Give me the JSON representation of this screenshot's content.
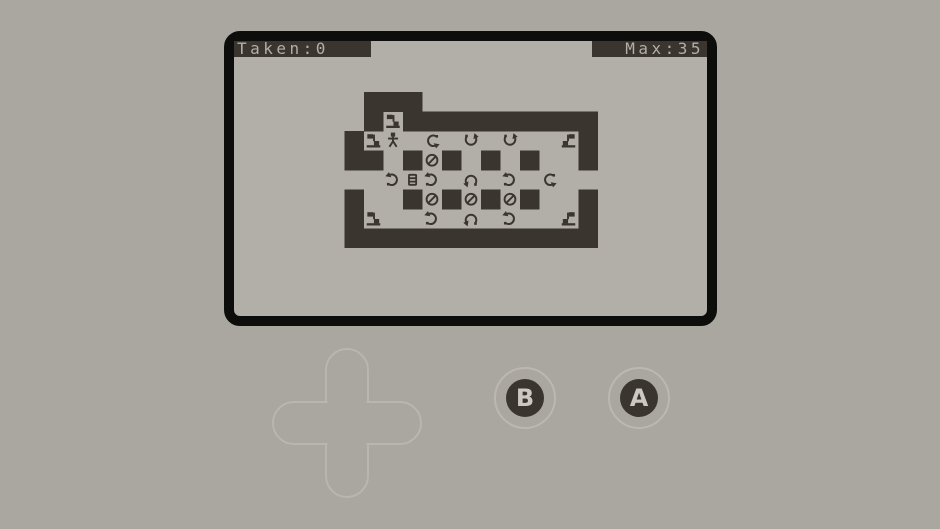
{
  "hud": {
    "taken_label": "Taken:0",
    "max_label": "Max:35",
    "taken_value": 0,
    "max_value": 35
  },
  "controls": {
    "button_b_label": "B",
    "button_a_label": "A"
  },
  "map": {
    "tile_size": 19.5,
    "cols": 13,
    "rows": 8,
    "grid": [
      " ###         ",
      " #F##########",
      "#FP.L.D.D..f#",
      "##.#O#.#.#..#",
      "..RBR.U.R.L..",
      "#..#O#O#O#..#",
      "#F..R.U.R..f#",
      "#############"
    ],
    "legend": {
      "#": "wall-block",
      ".": "floor",
      " ": "outside",
      "F": "flag-marker",
      "f": "flag-marker-mirrored",
      "P": "player-character",
      "O": "no-entry-sign",
      "B": "door-tile",
      "L": "turn-arrow-open-right",
      "R": "turn-arrow-open-left",
      "U": "turn-arrow-open-bottom",
      "D": "turn-arrow-open-top"
    }
  },
  "colors": {
    "page_bg": "#a9a79f",
    "screen_bg": "#b1afa7",
    "tile_dark": "#3a352e",
    "screen_frame": "#0d0d0b",
    "control_outline": "#bbb8b1",
    "button_label": "#ccc9c2"
  }
}
